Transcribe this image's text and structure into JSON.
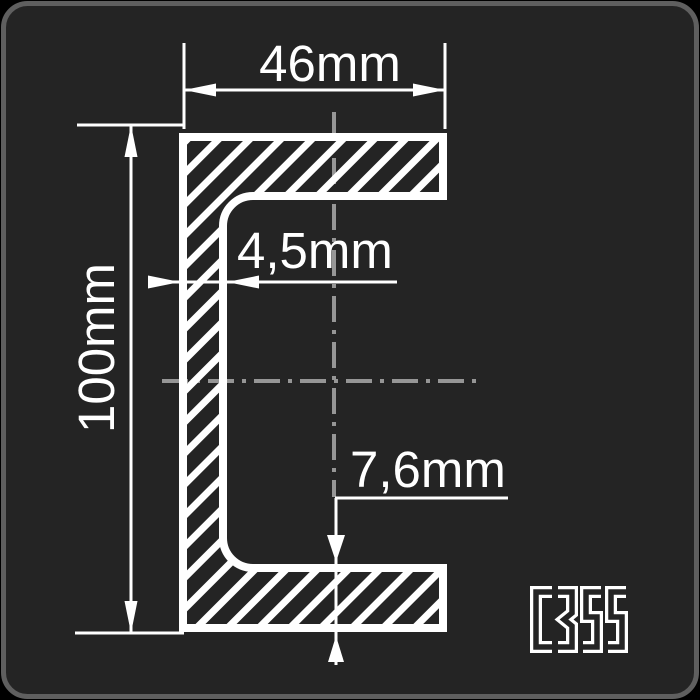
{
  "drawing": {
    "profile": {
      "steel_grade": "C355",
      "dimensions": {
        "flange_width": "46mm",
        "profile_height": "100mm",
        "web_thickness": "4,5mm",
        "flange_thickness": "7,6mm"
      }
    },
    "colors": {
      "panel_background": "#242424",
      "panel_border": "#5f5f5f",
      "drawing_line": "#ffffff",
      "centerline": "#969696"
    }
  }
}
